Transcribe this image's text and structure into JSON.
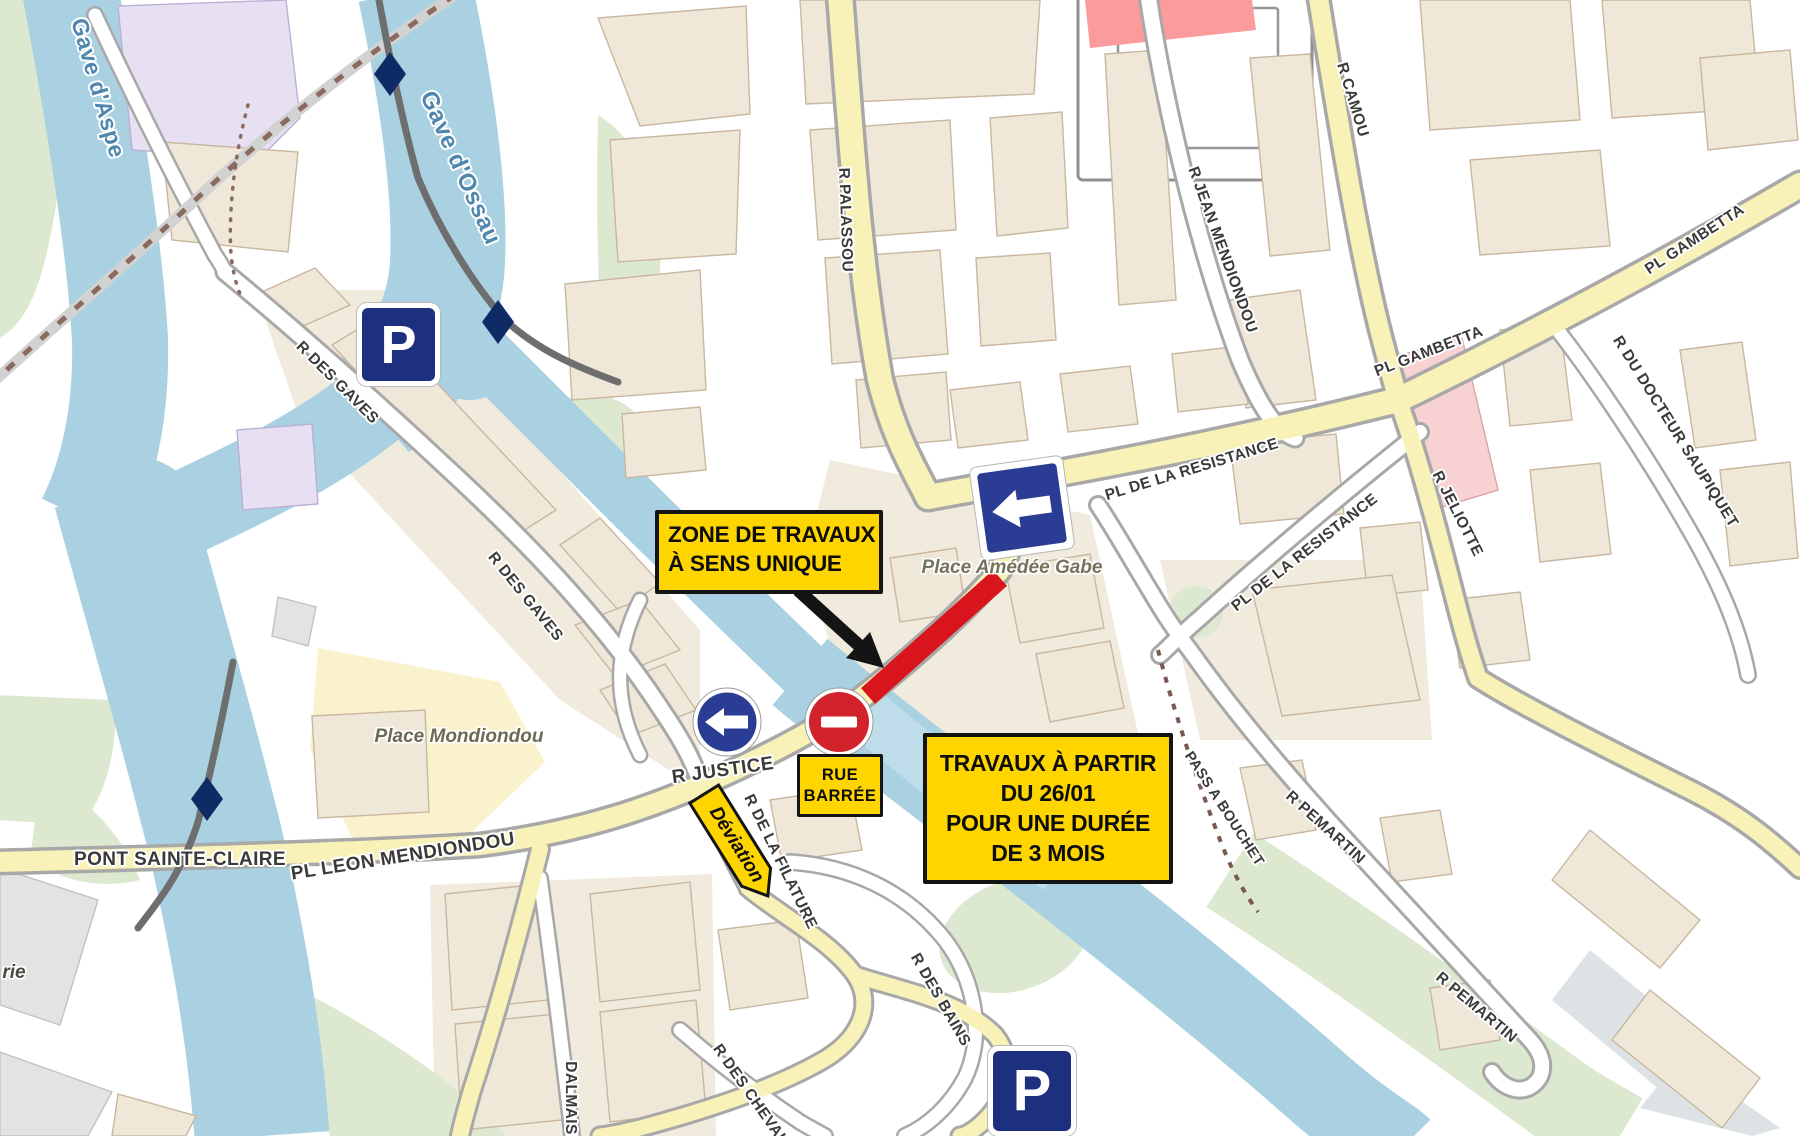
{
  "map": {
    "water_labels": {
      "gave_daspe": "Gave d'Aspe",
      "gave_dossau": "Gave d'Ossau"
    },
    "street_labels": {
      "r_palassou": "R PALASSOU",
      "r_jean_mendiondou": "R JEAN MENDIONDOU",
      "r_camou": "R CAMOU",
      "pl_gambetta": "PL GAMBETTA",
      "r_du_docteur_saupiquet": "R DU DOCTEUR SAUPIQUET",
      "r_jeliotte": "R JELIOTTE",
      "pl_de_la_resistance": "PL DE LA RESISTANCE",
      "r_des_gaves": "R DES GAVES",
      "r_justice": "R JUSTICE",
      "pont_sainte_claire": "PONT SAINTE-CLAIRE",
      "pl_leon_mendiondou": "PL LEON MENDIONDOU",
      "pass_a_bouchet": "PASS A BOUCHET",
      "r_pemartin": "R PEMARTIN",
      "r_de_la_filature": "R DE LA FILATURE",
      "r_des_bains": "R DES BAINS",
      "r_des_chevaliers": "R DES CHEVAL",
      "dalmais": "DALMAIS"
    },
    "place_labels": {
      "amedee_gabe": "Place Amédée Gabe",
      "mondiondou": "Place Mondiondou",
      "partial_rie": "rie"
    },
    "annotations": {
      "zone_travaux": {
        "line1": "ZONE DE TRAVAUX",
        "line2": "À SENS UNIQUE"
      },
      "travaux_dates": {
        "line1": "TRAVAUX À PARTIR",
        "line2": "DU 26/01",
        "line3": "POUR UNE DURÉE",
        "line4": "DE 3 MOIS"
      },
      "rue_barree": {
        "line1": "RUE",
        "line2": "BARRÉE"
      },
      "deviation": "Déviation"
    },
    "signs": {
      "parking_letter": "P"
    },
    "colors": {
      "annotation_yellow": "#FFD500",
      "roadwork_red": "#D8151C",
      "sign_blue": "#2B3C94",
      "parking_blue": "#1D3080",
      "no_entry_red": "#D2222B",
      "water_blue": "#A9D1E2",
      "road_yellow": "#F8F2B8",
      "building_tan": "#EFE7D7"
    }
  }
}
